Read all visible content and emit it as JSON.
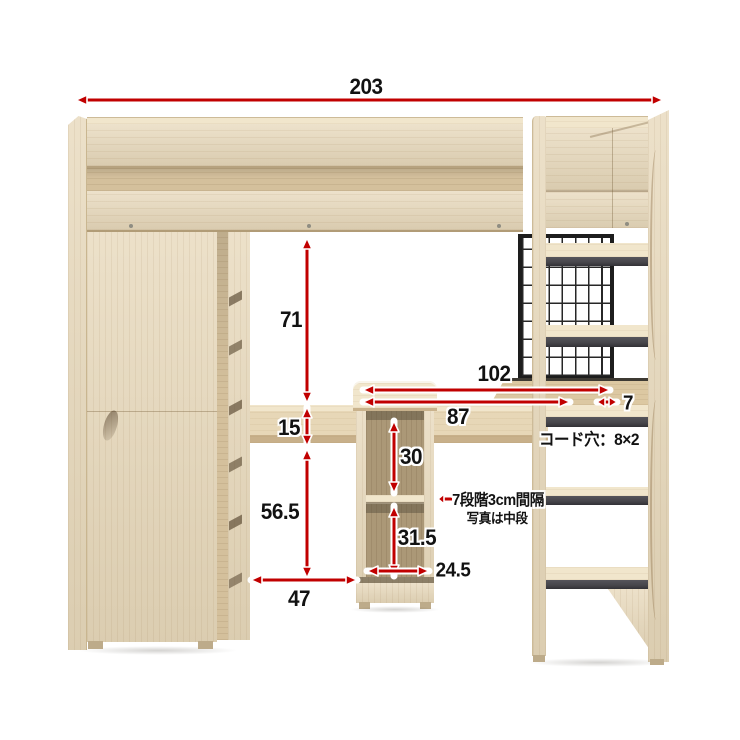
{
  "diagram": {
    "kind": "loft-bed-with-desk dimension diagram",
    "background": "#ffffff"
  },
  "colors": {
    "arrow_red": "#c10000",
    "wood_base": "#e7d8ba",
    "wood_light": "#f1e6cc",
    "wood_shade": "#d4c09c",
    "step_gray": "#46454a",
    "mesh_black": "#1d1d1d"
  },
  "labels": {
    "total_width": "203",
    "under_bed_clearance": "71",
    "desk_thickness": "15",
    "under_desk_clearance": "56.5",
    "left_opening_width": "47",
    "desk_total_width": "102",
    "desk_left_width": "87",
    "desk_right_width": "7",
    "shelf_upper_opening": "30",
    "shelf_lower_opening": "31.5",
    "shelf_opening_width": "24.5",
    "cord_hole_note": "コード穴：8×2",
    "shelf_note_line1": "7段階3cm間隔",
    "shelf_note_line2": "写真は中段"
  }
}
